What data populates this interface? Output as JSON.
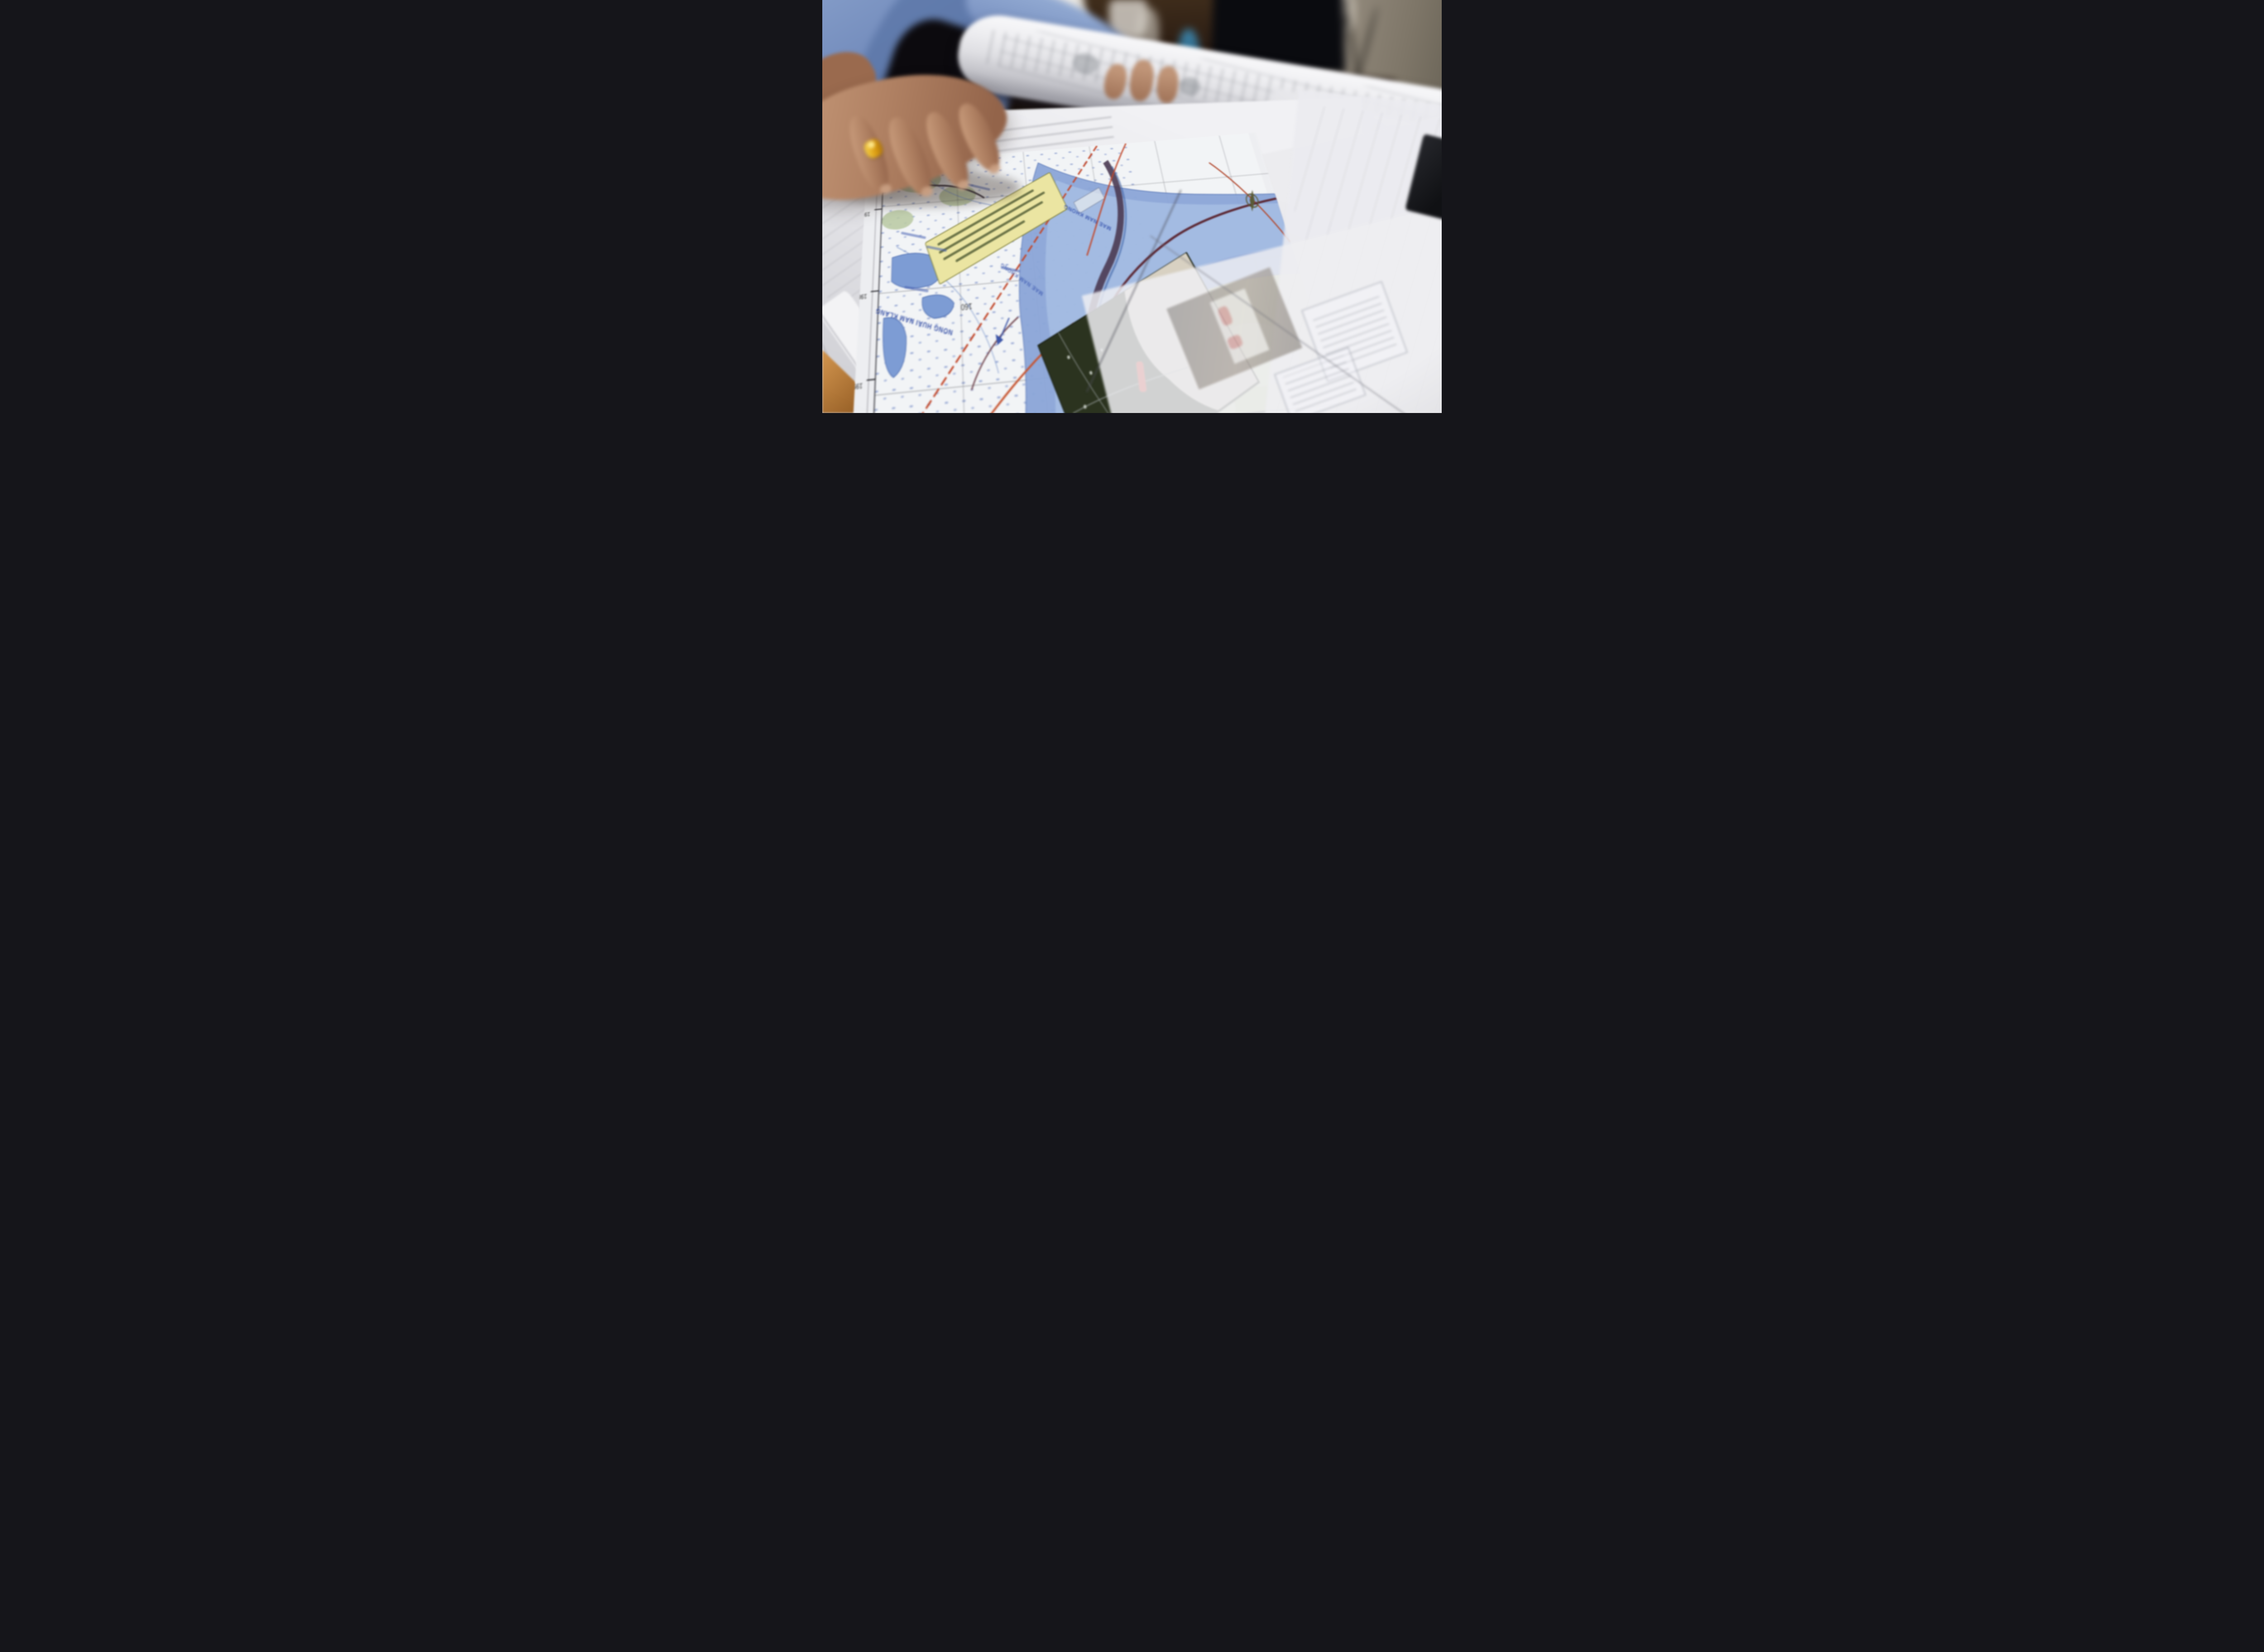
{
  "scene": {
    "palette": {
      "shirt_blue": "#7d96c4",
      "skin": "#b5866a",
      "ring_gold": "#e0a81d",
      "paper_white": "#e9e9ed",
      "desk_wood": "#8a6038",
      "table_corner_wood": "#c08a4a",
      "wall_beige": "#93897c",
      "monitor_black": "#0b0c10",
      "map_river_blue": "#8fa6d6",
      "map_channel_dark": "#4c3a55",
      "map_yellow_label": "#ebe5a2",
      "map_red_road": "#c2472a",
      "map_green_field": "#ccd8ab",
      "map_label_blue": "#3c55a8",
      "satellite_dark_green": "#2b331f",
      "satellite_sand": "#d8d1c2",
      "satellite_red_mark": "#d22718"
    }
  },
  "roll": {
    "logo": "UT"
  },
  "map": {
    "elevation_label": "160",
    "grid_labels": [
      "1986000",
      "1988000",
      "1989000",
      "1990000"
    ],
    "place_labels": [
      "NONG HUAI NAM KLANG",
      "NONG PHEN DUEAN"
    ],
    "river_label": "MAE NAM KHONG",
    "inset_watermark": "Google"
  }
}
